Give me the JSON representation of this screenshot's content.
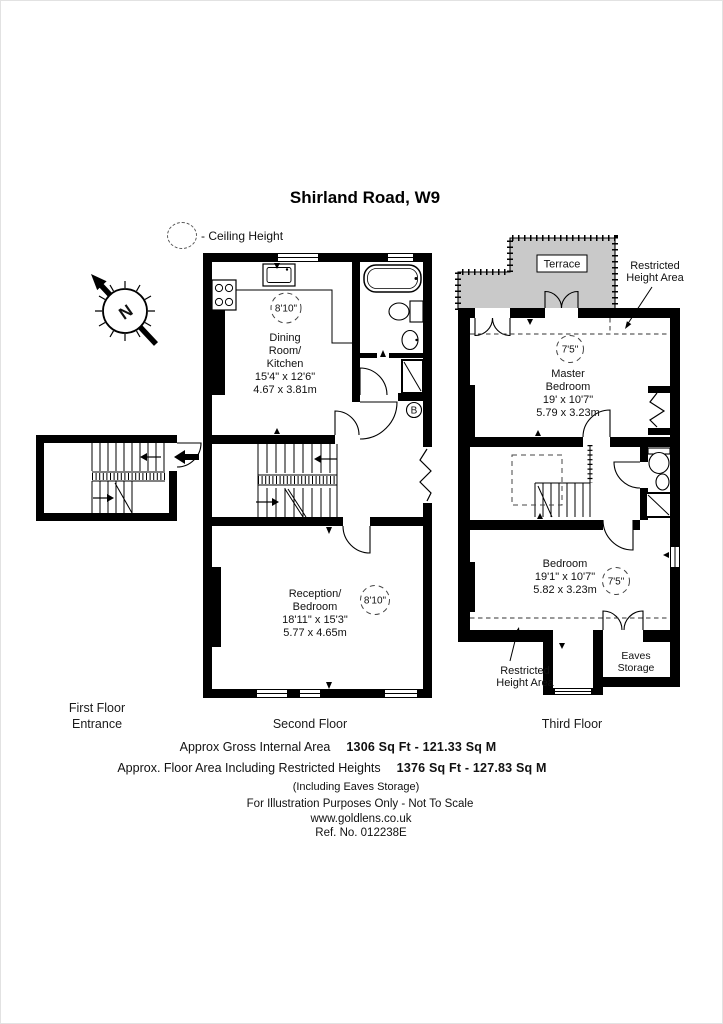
{
  "title": "Shirland Road, W9",
  "legend": {
    "label": "- Ceiling Height"
  },
  "compass": {
    "north": "N"
  },
  "entrance": {
    "caption_line1": "First Floor",
    "caption_line2": "Entrance"
  },
  "second_floor": {
    "caption": "Second Floor",
    "dining": {
      "line1": "Dining",
      "line2": "Room/",
      "line3": "Kitchen",
      "dims_ft": "15'4\" x 12'6\"",
      "dims_m": "4.67 x 3.81m",
      "ceiling": "8'10\""
    },
    "reception": {
      "line1": "Reception/",
      "line2": "Bedroom",
      "dims_ft": "18'11\" x 15'3\"",
      "dims_m": "5.77 x 4.65m",
      "ceiling": "8'10\""
    },
    "boiler": "B"
  },
  "third_floor": {
    "caption": "Third Floor",
    "terrace": "Terrace",
    "restricted_top_line1": "Restricted",
    "restricted_top_line2": "Height Area",
    "restricted_bottom_line1": "Restricted",
    "restricted_bottom_line2": "Height Area",
    "master": {
      "line1": "Master",
      "line2": "Bedroom",
      "dims_ft": "19' x 10'7\"",
      "dims_m": "5.79 x 3.23m",
      "ceiling": "7'5\""
    },
    "bedroom": {
      "line1": "Bedroom",
      "dims_ft": "19'1\" x 10'7\"",
      "dims_m": "5.82 x 3.23m",
      "ceiling": "7'5\""
    },
    "eaves_line1": "Eaves",
    "eaves_line2": "Storage"
  },
  "footer": {
    "gross_label": "Approx Gross Internal Area",
    "gross_value": "1306 Sq Ft  -  121.33 Sq M",
    "restricted_label": "Approx. Floor Area Including Restricted Heights",
    "restricted_value": "1376 Sq Ft  -  127.83 Sq M",
    "including": "(Including Eaves Storage)",
    "disclaimer": "For Illustration Purposes Only - Not To Scale",
    "website": "www.goldlens.co.uk",
    "reference": "Ref. No. 012238E"
  },
  "colors": {
    "wall": "#000000",
    "terrace_fill": "#c9c9c9",
    "background": "#ffffff"
  }
}
